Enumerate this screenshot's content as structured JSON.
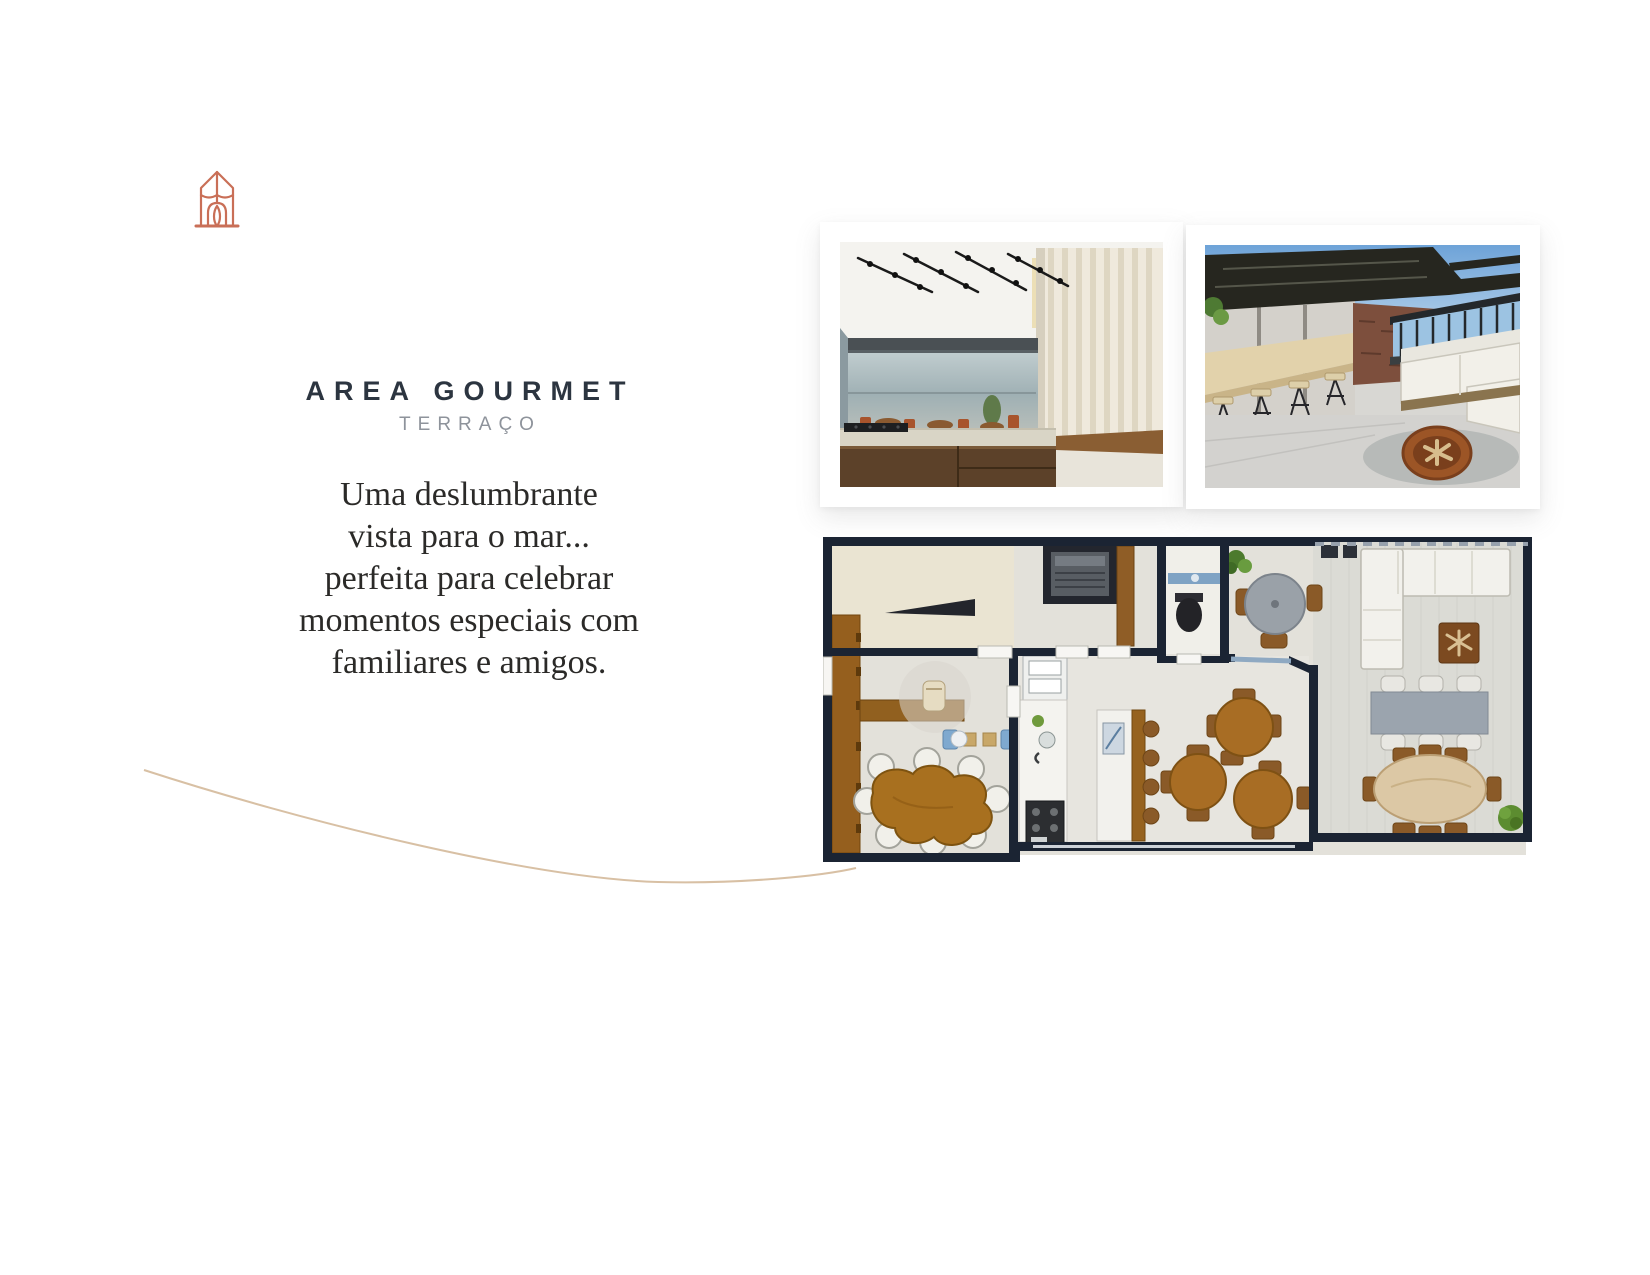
{
  "page": {
    "background": "#ffffff"
  },
  "logo": {
    "icon": "house-arch-logo-icon",
    "color": "#c96f57"
  },
  "heading": {
    "title": "AREA GOURMET",
    "subtitle": "TERRAÇO"
  },
  "intro": {
    "lines": [
      "Uma deslumbrante",
      "vista para o mar...",
      "perfeita para celebrar",
      "momentos especiais com",
      "familiares e amigos."
    ]
  },
  "gallery": {
    "photos": [
      {
        "name": "gourmet-kitchen-render"
      },
      {
        "name": "terrace-lounge-render"
      }
    ]
  },
  "floor_plan": {
    "name": "area-gourmet-terrace-floor-plan"
  },
  "colors": {
    "accent_logo": "#c96f57",
    "title_text": "#2c3540",
    "subtitle_text": "#8e939b",
    "body_text": "#2b2a28",
    "plan_wall": "#1b2433",
    "plan_wood": "#a86d24",
    "curve_line": "#d8c0a4"
  }
}
